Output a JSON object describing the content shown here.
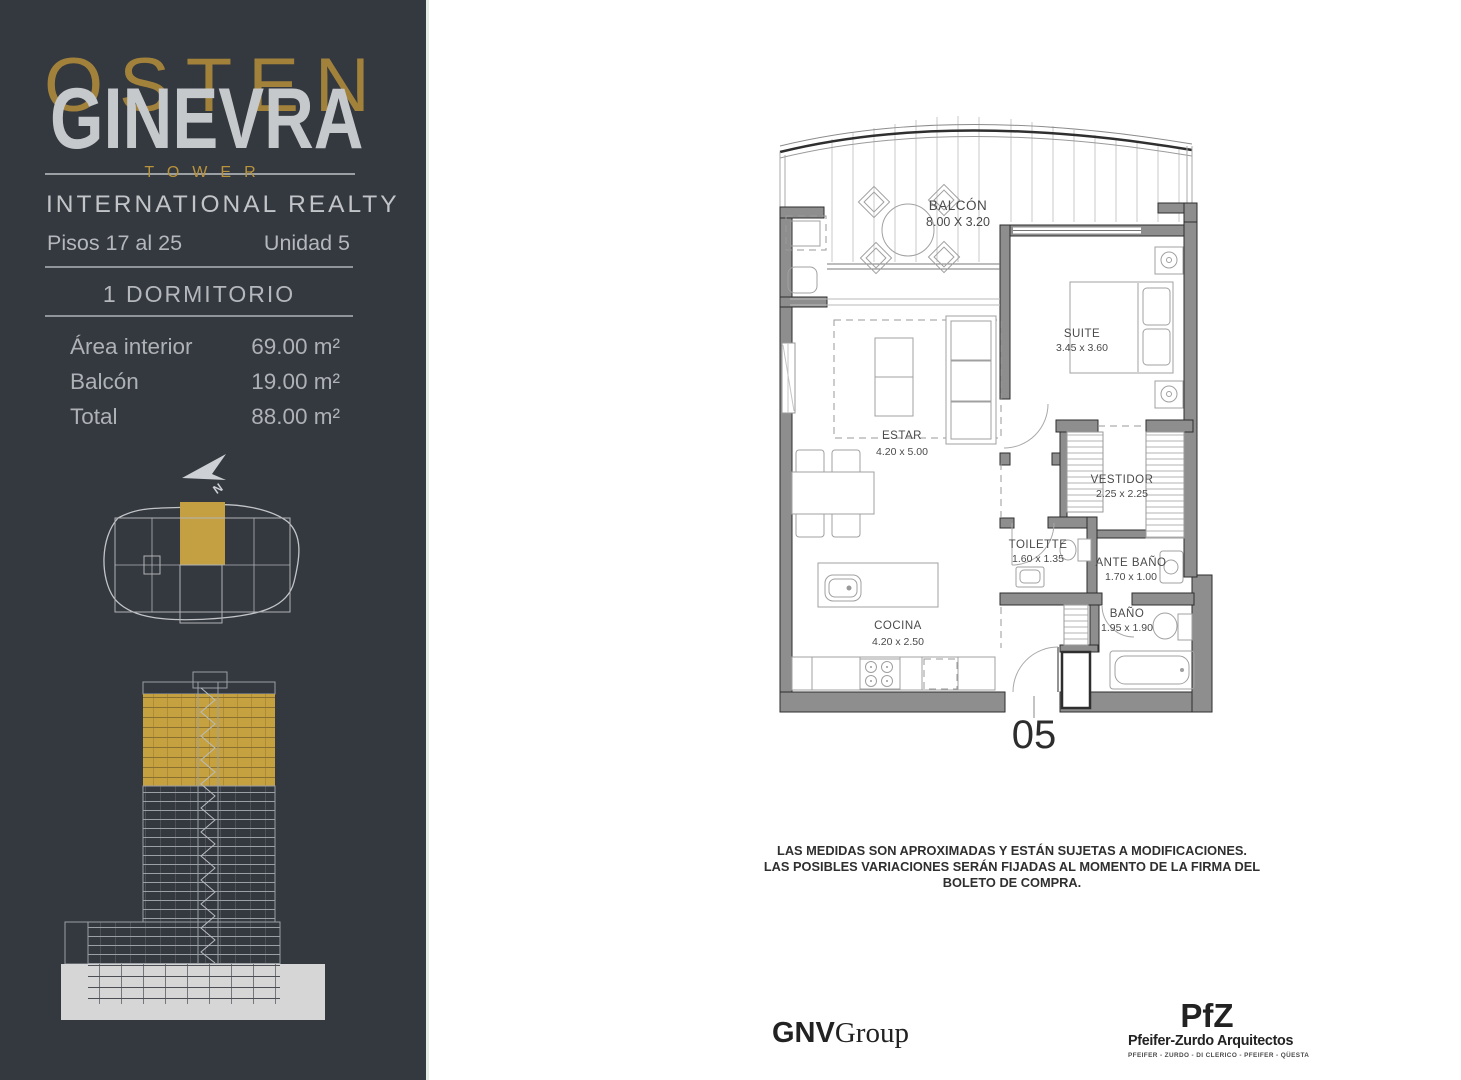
{
  "sidebar": {
    "watermark": "OSTEN",
    "brand": "GINEVRA",
    "tower": "TOWER",
    "subtitle": "INTERNATIONAL REALTY",
    "floors": "Pisos 17 al 25",
    "unit": "Unidad 5",
    "type": "1 DORMITORIO",
    "areas": [
      {
        "label": "Área interior",
        "value": "69.00 m²"
      },
      {
        "label": "Balcón",
        "value": "19.00 m²"
      },
      {
        "label": "Total",
        "value": "88.00 m²"
      }
    ]
  },
  "floor_plan": {
    "unit_number": "05",
    "rooms": [
      {
        "name": "BALCÓN",
        "dims": "8.00 X 3.20"
      },
      {
        "name": "SUITE",
        "dims": "3.45 x 3.60"
      },
      {
        "name": "ESTAR",
        "dims": "4.20 x 5.00"
      },
      {
        "name": "VESTIDOR",
        "dims": "2.25 x 2.25"
      },
      {
        "name": "TOILETTE",
        "dims": "1.60 x 1.35"
      },
      {
        "name": "ANTE BAÑO",
        "dims": "1.70 x 1.00"
      },
      {
        "name": "BAÑO",
        "dims": "1.95 x 1.90"
      },
      {
        "name": "COCINA",
        "dims": "4.20 x 2.50"
      }
    ]
  },
  "disclaimer": {
    "line1": "LAS MEDIDAS SON APROXIMADAS Y ESTÁN SUJETAS A MODIFICACIONES.",
    "line2": "LAS POSIBLES VARIACIONES SERÁN FIJADAS AL MOMENTO DE LA FIRMA DEL BOLETO DE COMPRA."
  },
  "footer": {
    "developer_bold": "GNV",
    "developer_rest": "Group",
    "architect_logo": "PfZ",
    "architect_name": "Pfeifer-Zurdo Arquitectos",
    "architect_partners": "PFEIFER - ZURDO - DI CLERICO - PFEIFER - QÜESTA"
  },
  "colors": {
    "sidebar_bg": "#34383f",
    "accent_gold": "#c0993d",
    "wall_gray": "#8e8e8e",
    "light_text": "#c2c5c8"
  }
}
